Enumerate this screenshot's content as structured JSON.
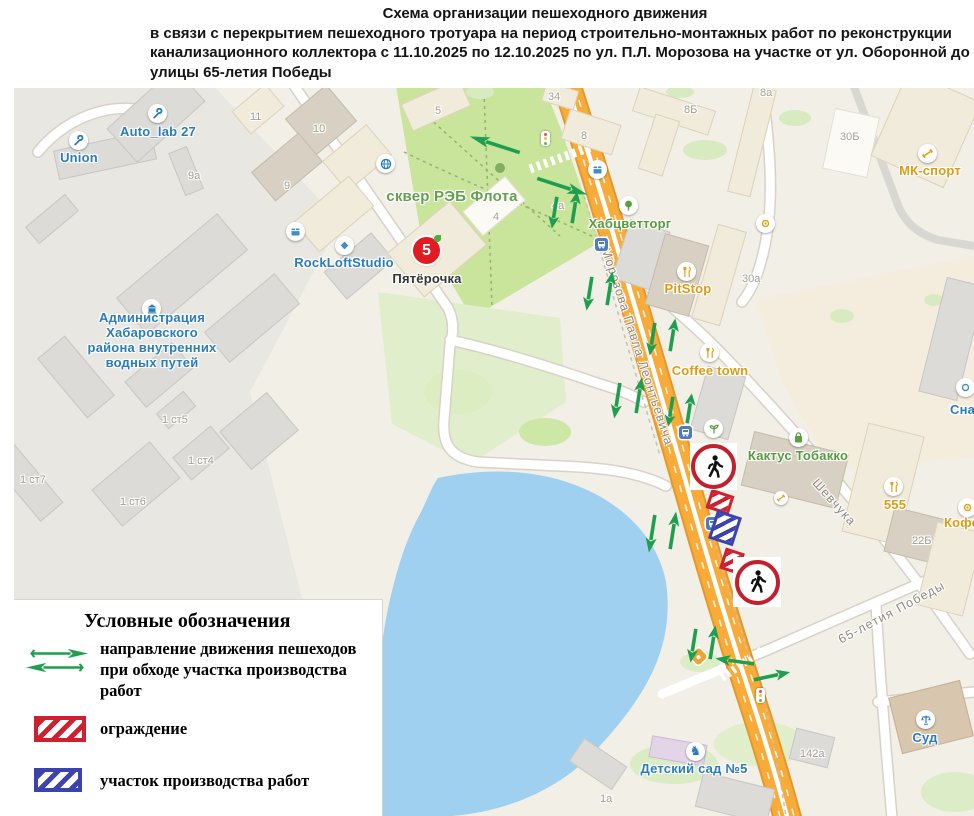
{
  "title": {
    "line1": "Схема организации пешеходного движения",
    "line2": "в связи с перекрытием пешеходного тротуара на период строительно-монтажных работ по реконструкции",
    "line3": "канализационного коллектора с 11.10.2025 по 12.10.2025 по ул. П.Л. Морозова на участке от ул. Оборонной до",
    "line4": "улицы 65-летия Победы"
  },
  "legend": {
    "title": "Условные обозначения",
    "routes_label": "направление движения пешеходов при обходе участка производства работ",
    "fence_label": "ограждение",
    "workzone_label": "участок производства работ"
  },
  "map": {
    "poi": {
      "union": "Union",
      "autolab": "Auto_lab 27",
      "admin": "Администрация Хабаровского района внутренних водных путей",
      "park": "сквер РЭБ Флота",
      "rockloft": "RockLoftStudio",
      "pyaterochka": "Пятёрочка",
      "habzvettorg": "Хабцветторг",
      "pitstop": "PitStop",
      "coffeetown": "Coffee town",
      "kaktus": "Кактус Тобакко",
      "mksport": "МК-спорт",
      "sna": "Сна",
      "n555": "555",
      "kofe": "Кофе",
      "sud": "Суд",
      "detsad": "Детский сад №5"
    },
    "streets": {
      "morozova": "Морозова Павла Леонтьевича",
      "shevchuka": "Шевчука",
      "pobedy": "65-летия Победы"
    },
    "numbers": {
      "n34": "34",
      "n8": "8",
      "n8b": "8Б",
      "n8a": "8а",
      "n30b": "30Б",
      "n30a": "30а",
      "n11": "11",
      "n10": "10",
      "n9": "9",
      "n9a": "9а",
      "n5": "5",
      "n4": "4",
      "n4a": "4а",
      "n1st5": "1 ст5",
      "n1st4": "1 ст4",
      "n1st6": "1 ст6",
      "n1st7": "1 ст7",
      "n22b": "22Б",
      "n142a": "142а",
      "n1a": "1а"
    },
    "p5_badge": "5"
  },
  "colors": {
    "road_orange": "#f8ab38",
    "arrow_green": "#1f9f4e",
    "fence_red": "#cf2030",
    "workzone_blue": "#3c42ae",
    "water": "#9fd0f0"
  }
}
